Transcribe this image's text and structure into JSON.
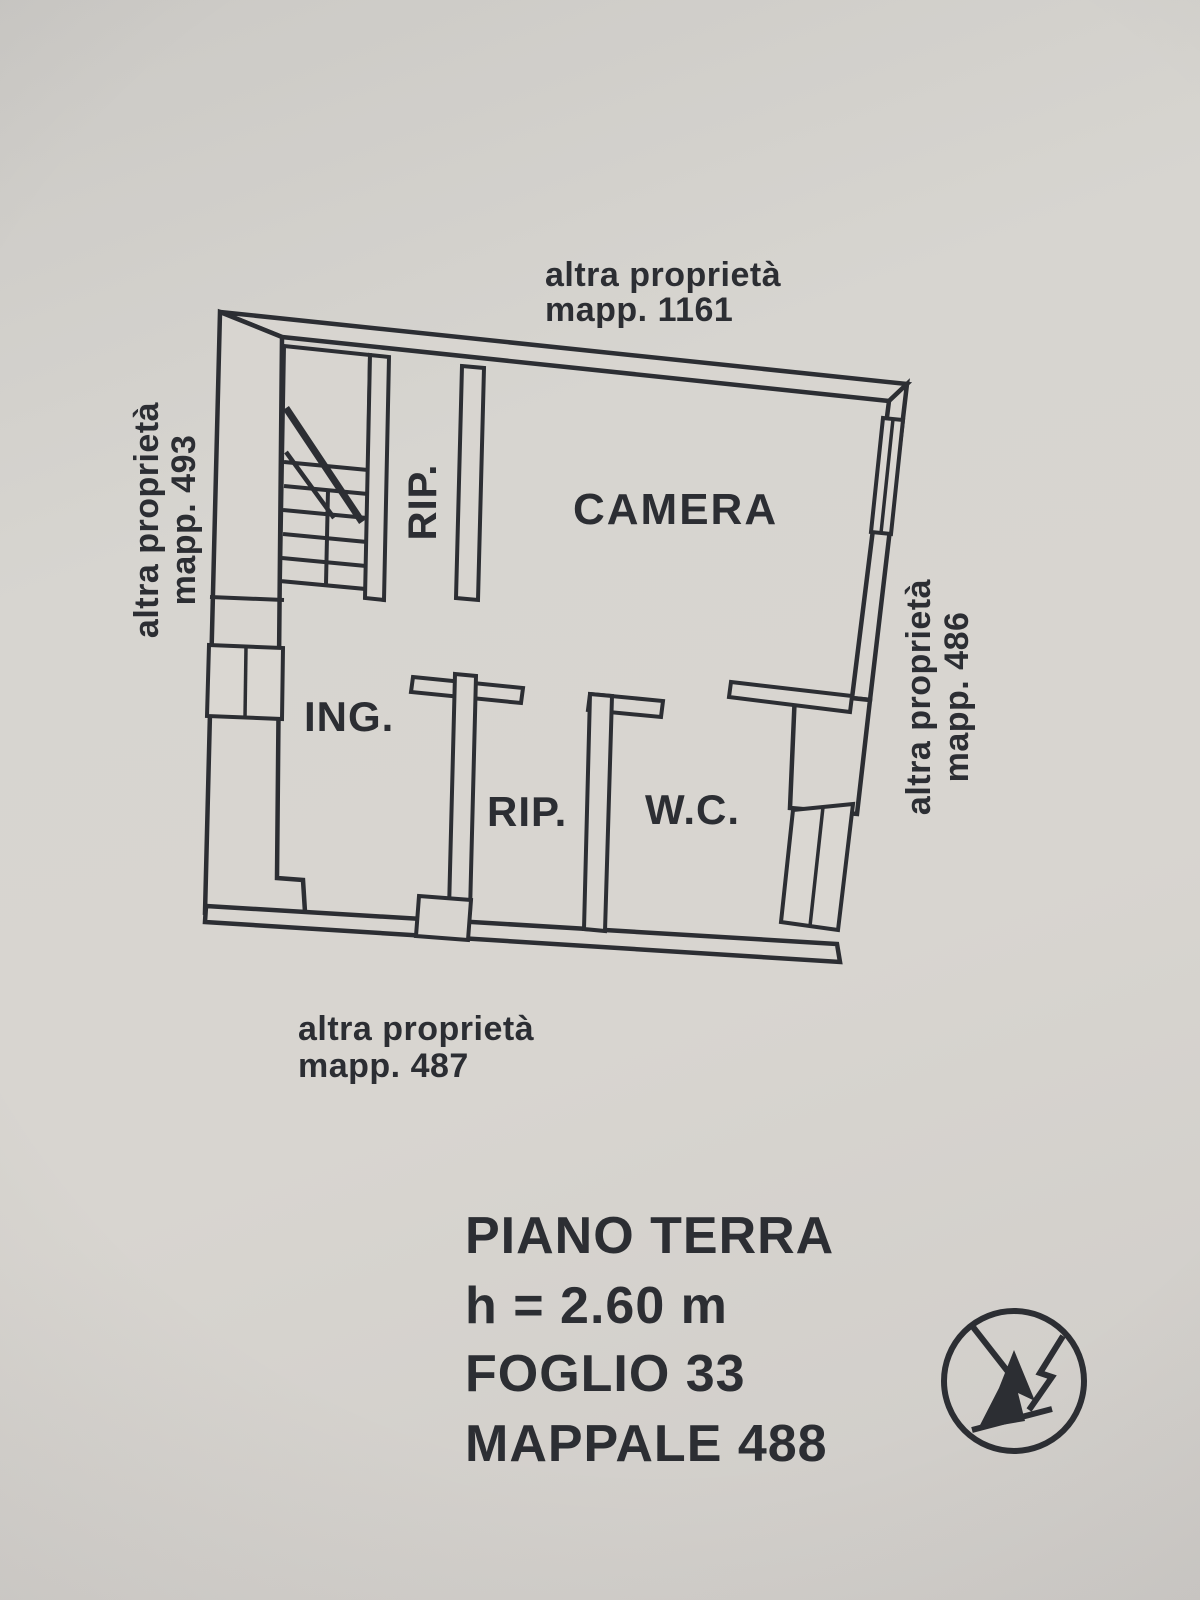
{
  "colors": {
    "paper": "#d5d2cd",
    "ink": "#2c2e33"
  },
  "neighbors": {
    "top": {
      "line1": "altra proprietà",
      "line2": "mapp. 1161"
    },
    "left": {
      "line1": "altra proprietà",
      "line2": "mapp. 493"
    },
    "right": {
      "line1": "altra proprietà",
      "line2": "mapp. 486"
    },
    "bottom": {
      "line1": "altra proprietà",
      "line2": "mapp. 487"
    }
  },
  "rooms": {
    "stair_closet": "RIP.",
    "camera": "CAMERA",
    "entrance": "ING.",
    "storage": "RIP.",
    "wc": "W.C."
  },
  "info": {
    "floor": "PIANO TERRA",
    "height": "h = 2.60 m",
    "sheet": "FOGLIO 33",
    "parcel": "MAPPALE 488"
  }
}
